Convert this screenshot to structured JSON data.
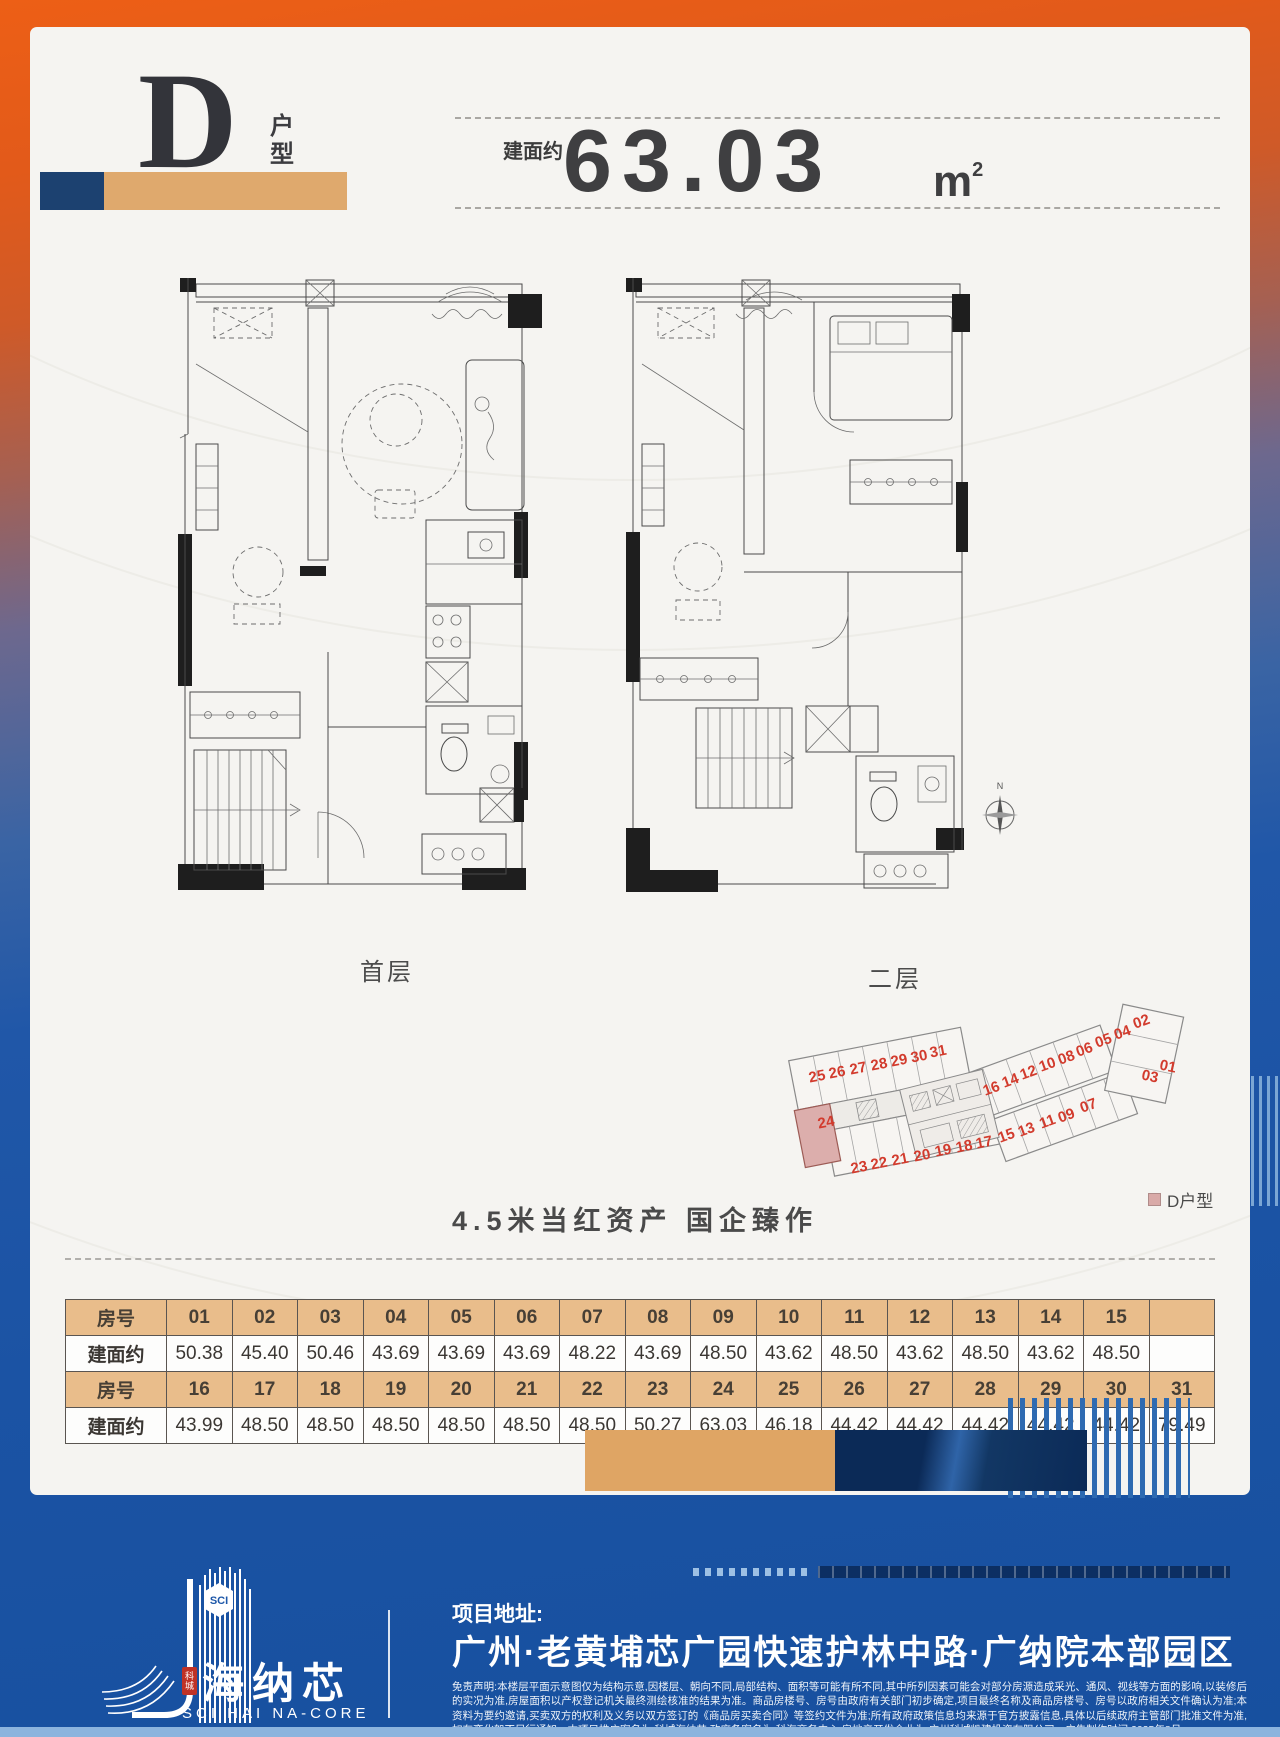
{
  "header": {
    "unit_letter": "D",
    "suffix_char1": "户",
    "suffix_char2": "型",
    "area_label": "建面约",
    "area_value": "63.03",
    "area_unit": "m",
    "area_sup": "2"
  },
  "plans": {
    "first_floor_label": "首层",
    "second_floor_label": "二层",
    "compass_north": "N"
  },
  "site_plan": {
    "legend_label": "D户型",
    "highlighted_unit": "24",
    "units": [
      {
        "label": "25",
        "x": 113,
        "y": 96,
        "rot": -11
      },
      {
        "label": "26",
        "x": 133,
        "y": 92,
        "rot": -11
      },
      {
        "label": "27",
        "x": 154,
        "y": 88,
        "rot": -11
      },
      {
        "label": "28",
        "x": 175,
        "y": 84,
        "rot": -11
      },
      {
        "label": "29",
        "x": 195,
        "y": 80,
        "rot": -11
      },
      {
        "label": "30",
        "x": 215,
        "y": 76,
        "rot": -11
      },
      {
        "label": "31",
        "x": 234,
        "y": 71,
        "rot": -11
      },
      {
        "label": "24",
        "x": 122,
        "y": 142,
        "rot": -11
      },
      {
        "label": "23",
        "x": 155,
        "y": 187,
        "rot": -11
      },
      {
        "label": "22",
        "x": 175,
        "y": 183,
        "rot": -11
      },
      {
        "label": "21",
        "x": 196,
        "y": 179,
        "rot": -11
      },
      {
        "label": "20",
        "x": 218,
        "y": 175,
        "rot": -11
      },
      {
        "label": "19",
        "x": 239,
        "y": 170,
        "rot": -11
      },
      {
        "label": "18",
        "x": 260,
        "y": 166,
        "rot": -11
      },
      {
        "label": "17",
        "x": 280,
        "y": 162,
        "rot": -11
      },
      {
        "label": "16",
        "x": 288,
        "y": 108,
        "rot": -20
      },
      {
        "label": "14",
        "x": 307,
        "y": 100,
        "rot": -20
      },
      {
        "label": "12",
        "x": 325,
        "y": 92,
        "rot": -20
      },
      {
        "label": "10",
        "x": 344,
        "y": 84,
        "rot": -20
      },
      {
        "label": "08",
        "x": 363,
        "y": 77,
        "rot": -20
      },
      {
        "label": "06",
        "x": 381,
        "y": 69,
        "rot": -20
      },
      {
        "label": "05",
        "x": 400,
        "y": 60,
        "rot": -20
      },
      {
        "label": "04",
        "x": 419,
        "y": 52,
        "rot": -20
      },
      {
        "label": "02",
        "x": 438,
        "y": 41,
        "rot": -20
      },
      {
        "label": "15",
        "x": 303,
        "y": 155,
        "rot": -20
      },
      {
        "label": "13",
        "x": 323,
        "y": 149,
        "rot": -20
      },
      {
        "label": "11",
        "x": 344,
        "y": 141,
        "rot": -20
      },
      {
        "label": "09",
        "x": 363,
        "y": 135,
        "rot": -20
      },
      {
        "label": "07",
        "x": 385,
        "y": 125,
        "rot": -20
      },
      {
        "label": "01",
        "x": 462,
        "y": 86,
        "rot": 12
      },
      {
        "label": "03",
        "x": 444,
        "y": 96,
        "rot": 12
      }
    ]
  },
  "tagline": "4.5米当红资产  国企臻作",
  "table": {
    "rows": [
      {
        "type": "header",
        "label": "房号",
        "cells": [
          "01",
          "02",
          "03",
          "04",
          "05",
          "06",
          "07",
          "08",
          "09",
          "10",
          "11",
          "12",
          "13",
          "14",
          "15",
          ""
        ]
      },
      {
        "type": "value",
        "label": "建面约",
        "cells": [
          "50.38",
          "45.40",
          "50.46",
          "43.69",
          "43.69",
          "43.69",
          "48.22",
          "43.69",
          "48.50",
          "43.62",
          "48.50",
          "43.62",
          "48.50",
          "43.62",
          "48.50",
          ""
        ]
      },
      {
        "type": "header",
        "label": "房号",
        "cells": [
          "16",
          "17",
          "18",
          "19",
          "20",
          "21",
          "22",
          "23",
          "24",
          "25",
          "26",
          "27",
          "28",
          "29",
          "30",
          "31"
        ]
      },
      {
        "type": "value",
        "label": "建面约",
        "cells": [
          "43.99",
          "48.50",
          "48.50",
          "48.50",
          "48.50",
          "48.50",
          "48.50",
          "50.27",
          "63.03",
          "46.18",
          "44.42",
          "44.42",
          "44.42",
          "44.42",
          "44.42",
          "79.49"
        ]
      }
    ]
  },
  "footer": {
    "logo": {
      "badge": "SCI",
      "seal_top": "科",
      "seal_bottom": "城",
      "cn": "海纳芯",
      "en": "SCI HAI NA-CORE"
    },
    "address_label": "项目地址:",
    "address": "广州·老黄埔芯广园快速护林中路·广纳院本部园区",
    "disclaimer": "免责声明:本楼层平面示意图仅为结构示意,因楼层、朝向不同,局部结构、面积等可能有所不同,其中所列因素可能会对部分房源造成采光、通风、视线等方面的影响,以装修后的实况为准,房屋面积以产权登记机关最终测绘核准的结果为准。商品房楼号、房号由政府有关部门初步确定,项目最终名称及商品房楼号、房号以政府相关文件确认为准;本资料为要约邀请,买卖双方的权利及义务以双方签订的《商品房买卖合同》等签约文件为准;所有政府政策信息均来源于官方披露信息,具体以后续政府主管部门批准文件为准,如有变化恕不另行通知。本项目推广案名为:科城海纳芯,政府备案名为:科海商务中心,房地产开发企业为:广州科城凯建投资有限公司。广告制作时间:2025年8月"
  },
  "colors": {
    "accent_orange": "#ed5f16",
    "brand_blue": "#1d56a7",
    "bar_navy": "#1c4170",
    "bar_tan": "#dfa96d",
    "table_header": "#e9bd8b",
    "unit_number_red": "#d23b2d",
    "highlight_pink": "#d9aaa8"
  }
}
